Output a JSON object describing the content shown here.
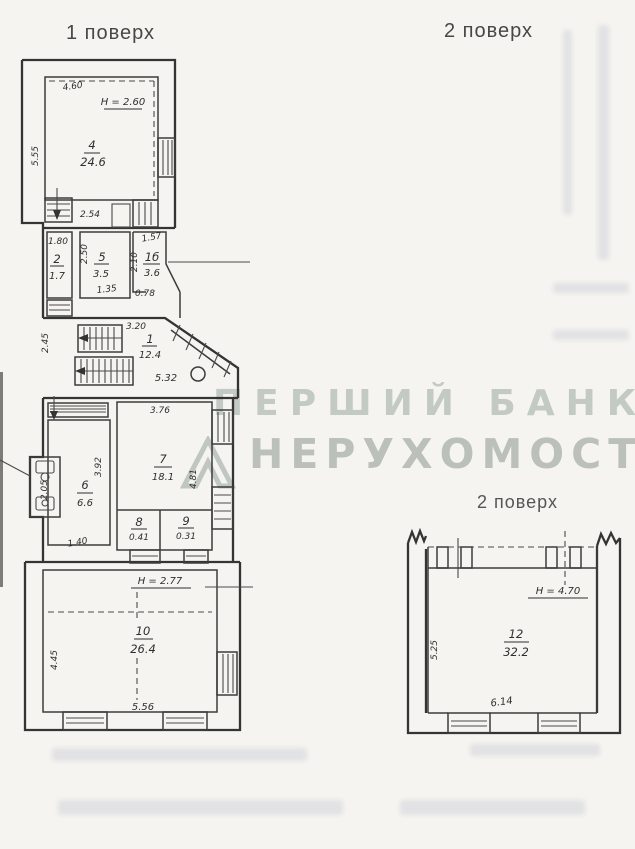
{
  "headings": {
    "floor1": "1 поверх",
    "floor2_top": "2 поверх",
    "floor2_bottom": "2 поверх"
  },
  "watermark": {
    "line1": "ПЕРШИЙ БАНК",
    "line2": "НЕРУХОМОСТІ"
  },
  "colors": {
    "paper": "#f5f4f0",
    "ink": "#343434",
    "watermark": "#929e95"
  },
  "floor1": {
    "room4": {
      "id": "4",
      "area": "24.6",
      "width": "4.60",
      "height_label": "H = 2.60",
      "side": "5.55",
      "bottom": "2.54"
    },
    "room2": {
      "id": "2",
      "area": "1.7",
      "top": "1.80"
    },
    "room5": {
      "id": "5",
      "area": "3.5",
      "side": "2.50",
      "bottom": "1.35"
    },
    "room1b": {
      "id": "1б",
      "area": "3.6",
      "top": "1.57",
      "side": "2.10",
      "bottom": "0.78"
    },
    "hall": {
      "id": "1",
      "area": "12.4",
      "top": "3.20",
      "side": "2.45",
      "bottom": "5.32"
    },
    "room6": {
      "id": "6",
      "area": "6.6",
      "side": "3.92",
      "bottom": "1.40"
    },
    "room7": {
      "id": "7",
      "area": "18.1",
      "top": "3.76",
      "side": "4.81"
    },
    "room8": {
      "id": "8",
      "area": "0.41"
    },
    "room9": {
      "id": "9",
      "area": "0.31"
    },
    "wc": {
      "side": "2.05"
    },
    "room10": {
      "id": "10",
      "area": "26.4",
      "height_label": "H = 2.77",
      "side": "4.45",
      "bottom": "5.56"
    }
  },
  "floor2": {
    "room12": {
      "id": "12",
      "area": "32.2",
      "height_label": "H = 4.70",
      "side": "5.25",
      "bottom": "6.14"
    }
  }
}
